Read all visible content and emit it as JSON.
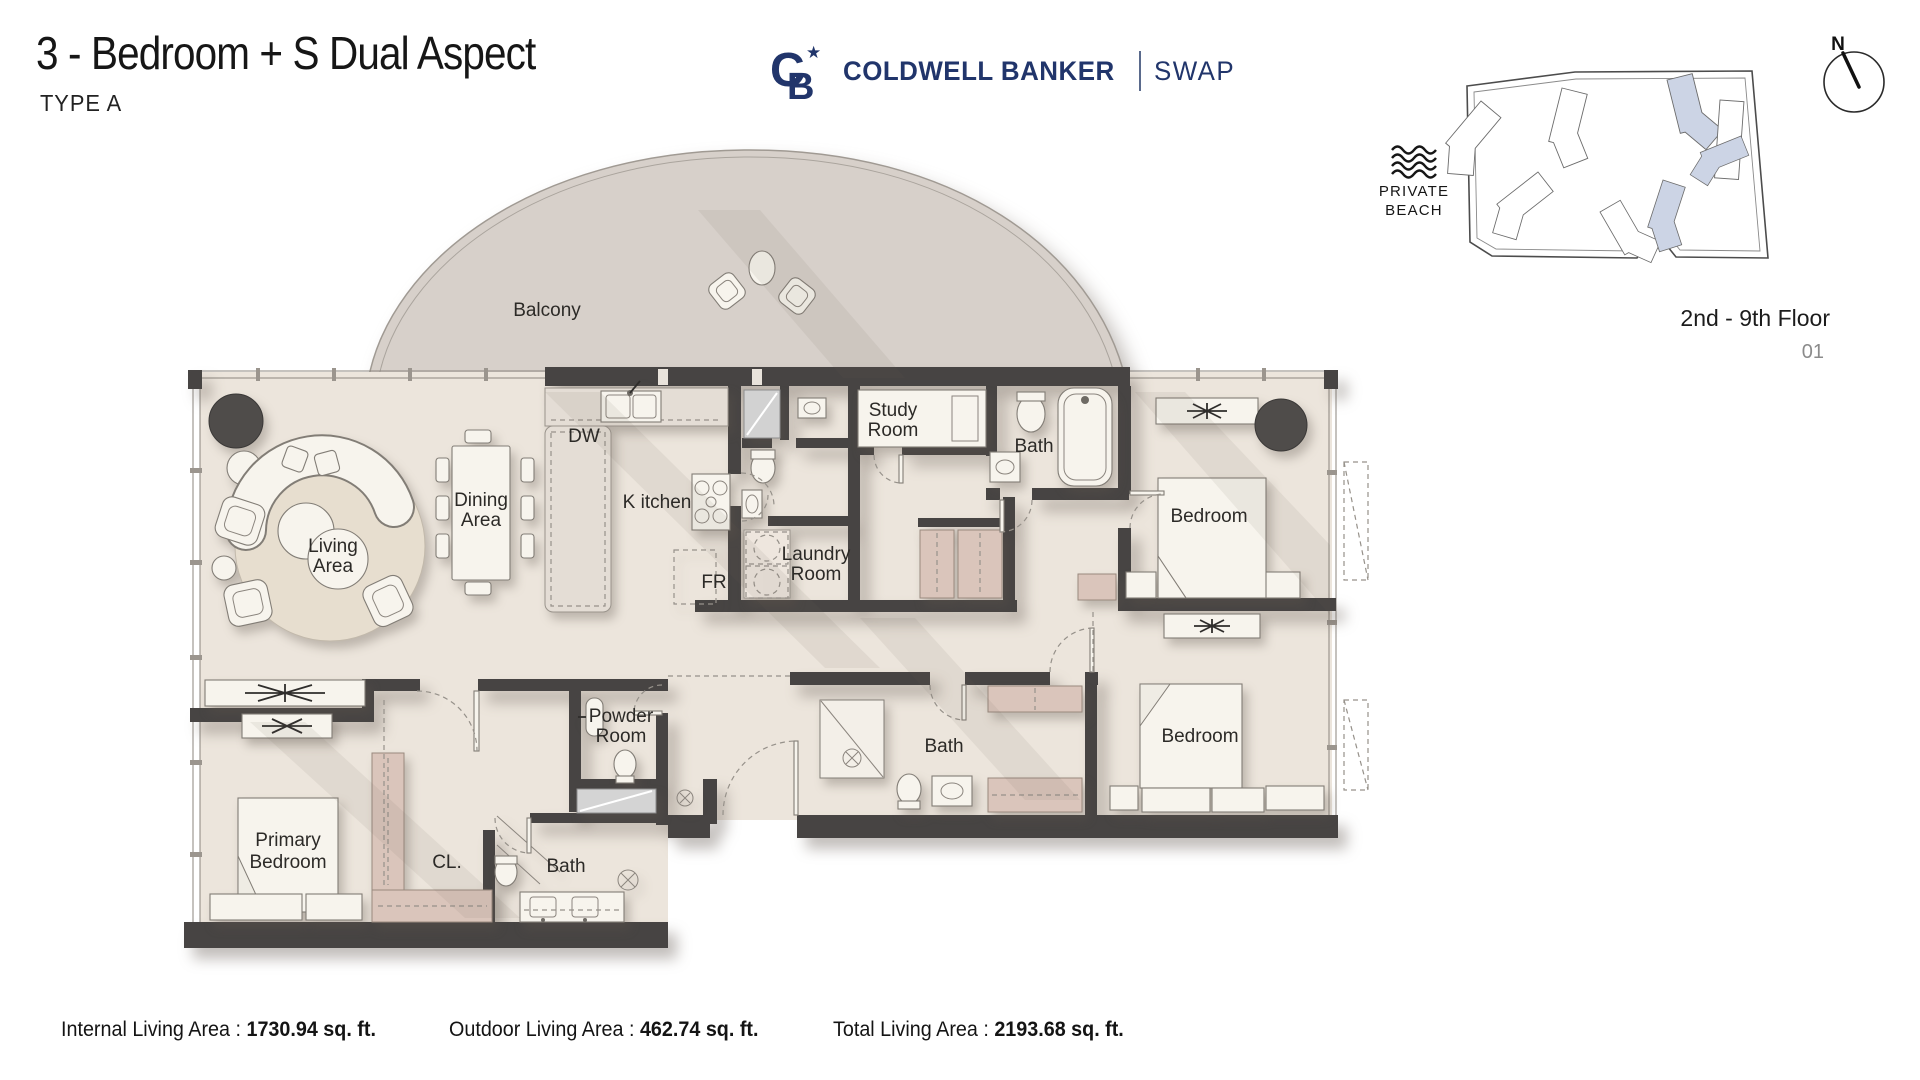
{
  "header": {
    "title": "3 - Bedroom + S Dual Aspect",
    "subtitle": "TYPE A"
  },
  "brand": {
    "monogram_c": "C",
    "monogram_b": "B",
    "star": "★",
    "name": "COLDWELL BANKER",
    "suffix": "SWAP"
  },
  "site": {
    "private_beach_line1": "PRIVATE",
    "private_beach_line2": "BEACH",
    "floor_range": "2nd - 9th Floor",
    "unit_number": "01",
    "compass_north": "N"
  },
  "plan": {
    "rooms": {
      "balcony": "Balcony",
      "dw": "DW",
      "kitchen": "K itchen",
      "fr": "FR",
      "laundry": [
        "Laundry",
        "Room"
      ],
      "study": [
        "Study",
        "Room"
      ],
      "bath_top": "Bath",
      "bedroom_top": "Bedroom",
      "dining": [
        "Dining",
        "Area"
      ],
      "living": [
        "Living",
        "Area"
      ],
      "powder": [
        "Powder",
        "Room"
      ],
      "bath_mid": "Bath",
      "bedroom_bottom": "Bedroom",
      "primary_bedroom": [
        "Primary",
        "Bedroom"
      ],
      "closet": "CL.",
      "bath_left": "Bath"
    }
  },
  "stats": [
    {
      "label": "Internal Living Area :",
      "value": "1730.94 sq. ft."
    },
    {
      "label": "Outdoor Living Area :",
      "value": "462.74 sq. ft."
    },
    {
      "label": "Total Living Area :",
      "value": "2193.68 sq. ft."
    }
  ],
  "colors": {
    "brand_navy": "#21356b",
    "wall": "#474443",
    "floor": "#ece5dc",
    "balcony": "#d7d0ca",
    "cabinet": "#dac5bb",
    "site_building_highlight": "#ccd4e5"
  }
}
